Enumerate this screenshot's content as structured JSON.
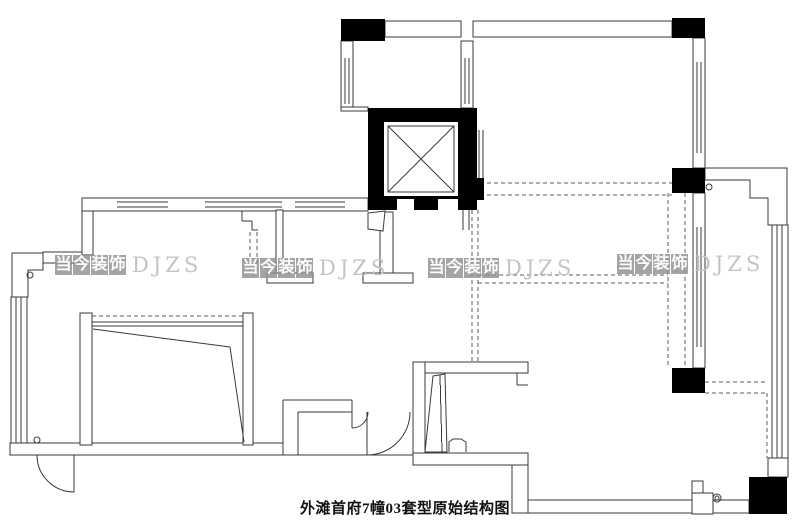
{
  "caption": "外滩首府7幢03套型原始结构图",
  "watermark": {
    "cjk": "当今装饰",
    "latin": "DJZS",
    "positions": [
      {
        "x": 55,
        "y": 253
      },
      {
        "x": 242,
        "y": 256
      },
      {
        "x": 428,
        "y": 256
      },
      {
        "x": 617,
        "y": 252
      }
    ]
  },
  "colors": {
    "line": "#3a3a3a",
    "dash": "#5c5c5c",
    "column_fill": "#000000",
    "background": "#ffffff",
    "watermark_chip": "#949494",
    "watermark_text": "#fcfcfc",
    "watermark_latin": "#c3c3c3"
  },
  "plan": {
    "canvas": {
      "w": 805,
      "h": 531
    },
    "columns": [
      [
        341,
        19,
        44,
        22
      ],
      [
        672,
        18,
        33,
        20
      ],
      [
        672,
        168,
        33,
        25
      ],
      [
        672,
        368,
        33,
        25
      ],
      [
        749,
        477,
        38,
        37
      ],
      [
        477,
        178,
        7,
        22
      ]
    ],
    "walls": [
      [
        385,
        21,
        76,
        16
      ],
      [
        473,
        21,
        199,
        16
      ],
      [
        341,
        41,
        12,
        67
      ],
      [
        461,
        41,
        12,
        67
      ],
      [
        341,
        107,
        27,
        4
      ],
      [
        693,
        38,
        12,
        130
      ],
      [
        82,
        198,
        286,
        13
      ],
      [
        82,
        211,
        11,
        44
      ],
      [
        43,
        252,
        39,
        11
      ],
      [
        11,
        297,
        16,
        146
      ],
      [
        10,
        443,
        273,
        12
      ],
      [
        80,
        313,
        12,
        132
      ],
      [
        243,
        313,
        10,
        132
      ],
      [
        276,
        210,
        7,
        63
      ],
      [
        267,
        273,
        46,
        10
      ],
      [
        380,
        212,
        13,
        61
      ],
      [
        363,
        273,
        50,
        10
      ],
      [
        413,
        362,
        12,
        103
      ],
      [
        425,
        362,
        103,
        11
      ],
      [
        413,
        453,
        115,
        12
      ],
      [
        512,
        465,
        16,
        48
      ],
      [
        528,
        500,
        221,
        13
      ],
      [
        693,
        193,
        12,
        175
      ],
      [
        768,
        458,
        20,
        19
      ],
      [
        772,
        225,
        16,
        233
      ],
      [
        692,
        481,
        11,
        12
      ],
      [
        692,
        493,
        21,
        21
      ]
    ],
    "polygons": [
      "12,253 43,253 43,270 28,270 28,297 12,297",
      "705,168 787,168 787,225 768,225 768,198 750,198 750,180 705,180",
      "368,213 385,211 383,231 368,229",
      "433,376 445,374 447,452 425,452"
    ],
    "lines": [
      [
        345,
        58,
        345,
        104
      ],
      [
        349,
        58,
        349,
        104
      ],
      [
        465,
        58,
        465,
        104
      ],
      [
        469,
        58,
        469,
        104
      ],
      [
        697,
        62,
        697,
        153
      ],
      [
        701,
        62,
        701,
        153
      ],
      [
        697,
        227,
        697,
        347
      ],
      [
        701,
        227,
        701,
        347
      ],
      [
        117,
        202,
        168,
        202
      ],
      [
        117,
        207,
        168,
        207
      ],
      [
        205,
        202,
        282,
        202
      ],
      [
        205,
        207,
        282,
        207
      ],
      [
        295,
        202,
        345,
        202
      ],
      [
        295,
        207,
        345,
        207
      ],
      [
        16,
        297,
        16,
        443
      ],
      [
        21,
        297,
        21,
        443
      ],
      [
        777,
        225,
        777,
        458
      ],
      [
        782,
        225,
        782,
        458
      ],
      [
        352,
        400,
        352,
        412
      ],
      [
        283,
        400,
        352,
        400
      ],
      [
        298,
        412,
        352,
        412
      ],
      [
        283,
        400,
        283,
        443
      ],
      [
        298,
        412,
        298,
        455
      ],
      [
        283,
        455,
        413,
        455
      ],
      [
        92,
        322,
        243,
        322
      ],
      [
        92,
        326,
        243,
        326
      ],
      [
        479,
        130,
        479,
        178
      ],
      [
        483,
        130,
        483,
        178
      ],
      [
        463,
        210,
        463,
        230
      ],
      [
        469,
        210,
        469,
        230
      ],
      [
        242,
        211,
        242,
        221
      ],
      [
        242,
        221,
        252,
        221
      ],
      [
        252,
        221,
        252,
        230
      ],
      [
        252,
        230,
        258,
        230
      ],
      [
        517,
        373,
        517,
        385
      ],
      [
        517,
        385,
        528,
        385
      ],
      [
        440,
        375,
        442,
        452
      ],
      [
        74,
        455,
        74,
        492
      ],
      [
        367,
        412,
        367,
        455
      ],
      [
        352,
        412,
        352,
        428
      ],
      [
        449,
        442,
        466,
        442
      ]
    ],
    "diag_lines": [
      [
        93,
        329,
        230,
        347
      ],
      [
        230,
        347,
        244,
        442
      ]
    ],
    "dashes": [
      [
        480,
        183,
        672,
        183
      ],
      [
        480,
        195,
        672,
        195
      ],
      [
        472,
        210,
        472,
        362
      ],
      [
        478,
        210,
        478,
        362
      ],
      [
        478,
        275,
        668,
        275
      ],
      [
        478,
        283,
        668,
        283
      ],
      [
        668,
        193,
        668,
        368
      ],
      [
        685,
        193,
        685,
        368
      ],
      [
        705,
        382,
        767,
        382
      ],
      [
        705,
        393,
        767,
        393
      ],
      [
        767,
        393,
        767,
        458
      ],
      [
        92,
        316,
        243,
        316
      ],
      [
        250,
        232,
        250,
        273
      ],
      [
        257,
        232,
        257,
        273
      ]
    ],
    "arcs": [
      "M37,455 A37,37 0 0 0 74,492",
      "M410,412 A43,43 0 0 1 367,455",
      "M368,412 A16,16 0 0 1 352,428"
    ],
    "paths": [
      "M449,452 L449,442 L453,439 L461,439 L466,442 L466,452"
    ],
    "circles": [
      [
        37,
        440,
        3
      ],
      [
        709,
        187,
        3
      ],
      [
        717,
        498,
        4
      ],
      [
        717,
        498,
        2
      ],
      [
        30,
        275,
        3
      ]
    ],
    "elevator": {
      "outer": [
        368,
        108,
        109,
        102
      ],
      "inner_white": [
        384,
        122,
        74,
        74
      ],
      "inner_frame": [
        388,
        126,
        66,
        66
      ],
      "door_gaps": [
        [
          397,
          199,
          17,
          11
        ],
        [
          438,
          199,
          20,
          11
        ]
      ]
    }
  }
}
